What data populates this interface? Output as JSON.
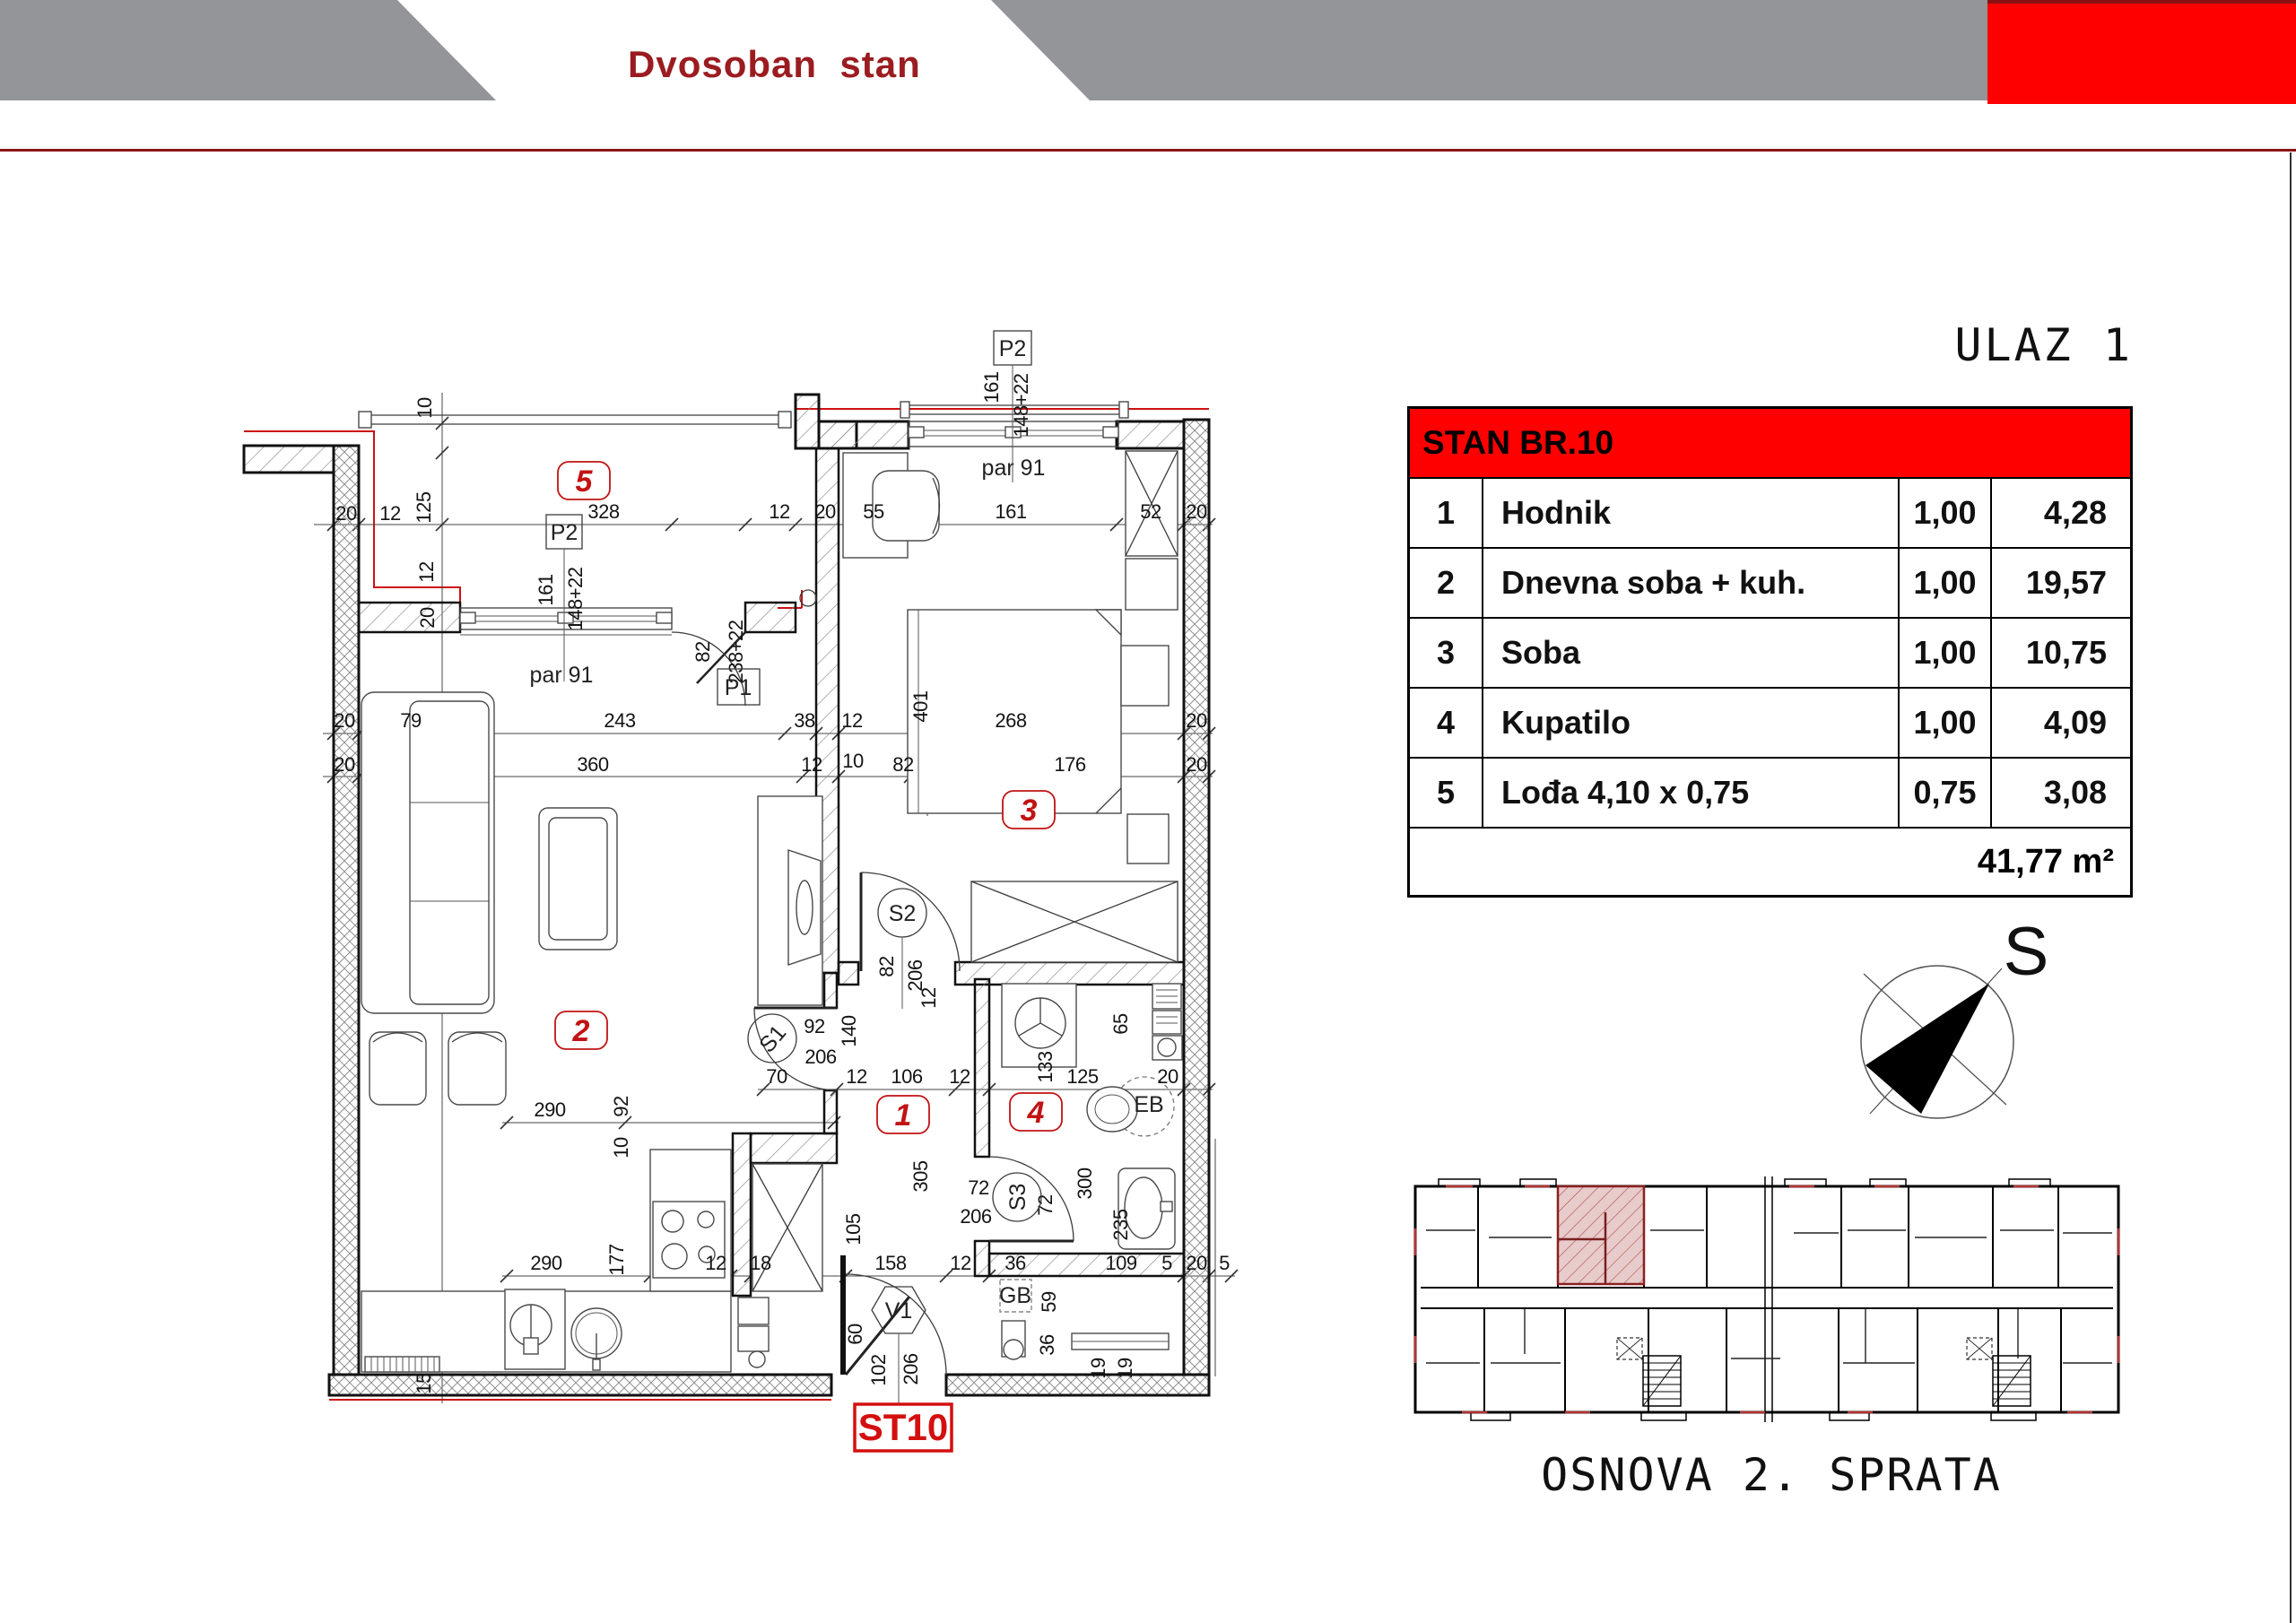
{
  "header": {
    "title": "Dvosoban  stan"
  },
  "entrance": {
    "title": "ULAZ 1"
  },
  "table": {
    "title": "STAN BR.10",
    "rows": [
      {
        "no": "1",
        "name": "Hodnik",
        "coef": "1,00",
        "area": "4,28"
      },
      {
        "no": "2",
        "name": "Dnevna soba + kuh.",
        "coef": "1,00",
        "area": "19,57"
      },
      {
        "no": "3",
        "name": "Soba",
        "coef": "1,00",
        "area": "10,75"
      },
      {
        "no": "4",
        "name": "Kupatilo",
        "coef": "1,00",
        "area": "4,09"
      },
      {
        "no": "5",
        "name": "Lođa 4,10 x 0,75",
        "coef": "0,75",
        "area": "3,08"
      }
    ],
    "total": "41,77 m²"
  },
  "compass": {
    "label": "S"
  },
  "overview": {
    "caption": "OSNOVA 2. SPRATA"
  },
  "plan": {
    "unit_label": "ST10",
    "rooms": [
      "1",
      "2",
      "3",
      "4",
      "5"
    ],
    "labels": {
      "p1": "P1",
      "p2": "P2",
      "s1": "S1",
      "s2": "S2",
      "s3": "S3",
      "v1": "V1",
      "gb": "GB",
      "eb": "EB",
      "par91": "par 91"
    },
    "dims": {
      "left": [
        "10",
        "20",
        "12",
        "125",
        "12",
        "20"
      ],
      "row585": [
        "328",
        "12",
        "20",
        "55",
        "161",
        "52",
        "20"
      ],
      "row818": [
        "20",
        "79",
        "243",
        "38",
        "12",
        "268",
        "20",
        "401"
      ],
      "row866": [
        "20",
        "360",
        "12",
        "10",
        "82",
        "176",
        "20"
      ],
      "row1215": [
        "92",
        "206",
        "140",
        "70",
        "12",
        "106",
        "12",
        "125",
        "20"
      ],
      "row1252": [
        "290",
        "92",
        "10"
      ],
      "row1423": [
        "290",
        "177",
        "12",
        "18",
        "105",
        "158",
        "12",
        "36",
        "109",
        "5",
        "20",
        "5"
      ],
      "p1": [
        "82",
        "238+22"
      ],
      "p2a": [
        "161",
        "148+22"
      ],
      "p2b": [
        "161",
        "148+22"
      ],
      "s2col": [
        "82",
        "206",
        "12"
      ],
      "s3area": [
        "72",
        "206",
        "72",
        "300",
        "305"
      ],
      "bath": [
        "133",
        "65",
        "235"
      ],
      "entry": [
        "60",
        "102",
        "206",
        "59",
        "36",
        "19",
        "19",
        "15"
      ]
    }
  }
}
